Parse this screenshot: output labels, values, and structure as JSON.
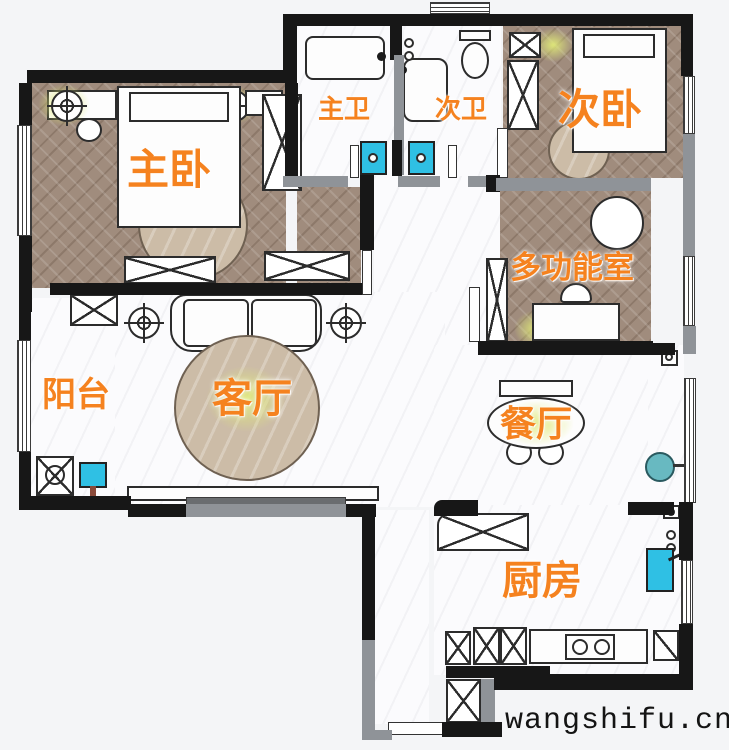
{
  "watermark": {
    "text": "wangshifu.cn"
  },
  "rooms": [
    {
      "id": "master-bedroom",
      "label": "主卧"
    },
    {
      "id": "master-bath",
      "label": "主卫"
    },
    {
      "id": "second-bath",
      "label": "次卫"
    },
    {
      "id": "second-bedroom",
      "label": "次卧"
    },
    {
      "id": "multi-function-room",
      "label": "多功能室"
    },
    {
      "id": "balcony",
      "label": "阳台"
    },
    {
      "id": "living-room",
      "label": "客厅"
    },
    {
      "id": "dining-room",
      "label": "餐厅"
    },
    {
      "id": "kitchen",
      "label": "厨房"
    }
  ],
  "colors": {
    "room_label": "#f5821f",
    "wall": "#171717",
    "wall_secondary": "#8f9398",
    "wood_floor": "#a08c7d",
    "tile_floor": "#fbfbfd",
    "fixture_cyan": "#2fc0e4",
    "basin_teal": "#68b9c1",
    "rug_tan": "#ccbca7",
    "lamp_glow": "#e0e978"
  },
  "symbols": {
    "ceiling_light": "crosshair-circle",
    "cabinet_wardrobe": "x-crossed-rect",
    "window": "parallel-lines"
  }
}
